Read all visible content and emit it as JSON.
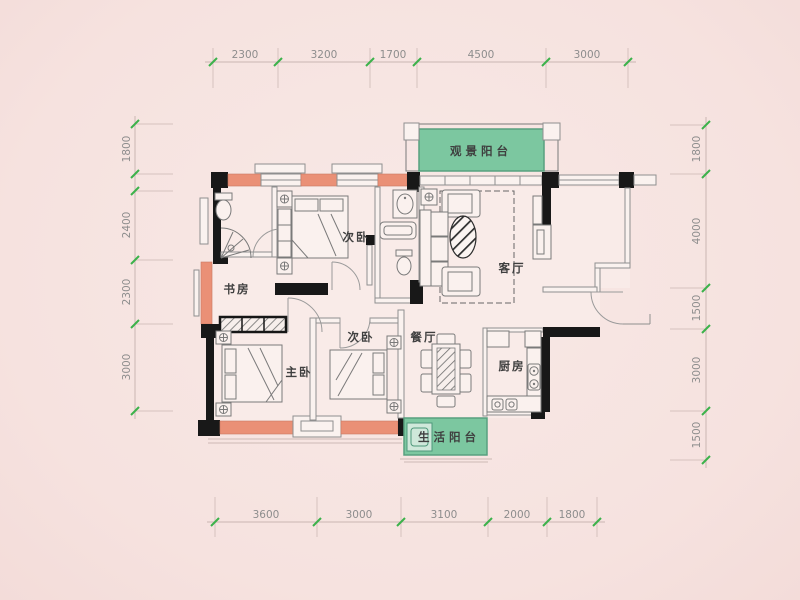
{
  "plan": {
    "title": "apartment-floor-plan",
    "rooms": {
      "view_balcony": {
        "label": "观景阳台"
      },
      "bedroom_top": {
        "label": "次卧"
      },
      "living": {
        "label": "客厅"
      },
      "study": {
        "label": "书房"
      },
      "master": {
        "label": "主卧"
      },
      "bedroom_mid": {
        "label": "次卧"
      },
      "dining": {
        "label": "餐厅"
      },
      "kitchen": {
        "label": "厨房"
      },
      "life_balcony": {
        "label": "生活阳台"
      }
    },
    "dimensions": {
      "top": [
        "2300",
        "3200",
        "1700",
        "4500",
        "3000"
      ],
      "bottom": [
        "3600",
        "3000",
        "3100",
        "2000",
        "1800"
      ],
      "left": [
        "1800",
        "2400",
        "2300",
        "3000"
      ],
      "right": [
        "1800",
        "4000",
        "1500",
        "3000",
        "1500"
      ]
    },
    "colors": {
      "background": "#f6e2df",
      "floor": "#f9ebe8",
      "exterior_wall_fill": "#ea9076",
      "structural_wall_fill": "#181818",
      "balcony_fill": "#7cc7a0",
      "dimension_tick": "#3cb24b",
      "dimension_text": "#8d8d8d",
      "room_label_text": "#3f3f3f"
    }
  }
}
